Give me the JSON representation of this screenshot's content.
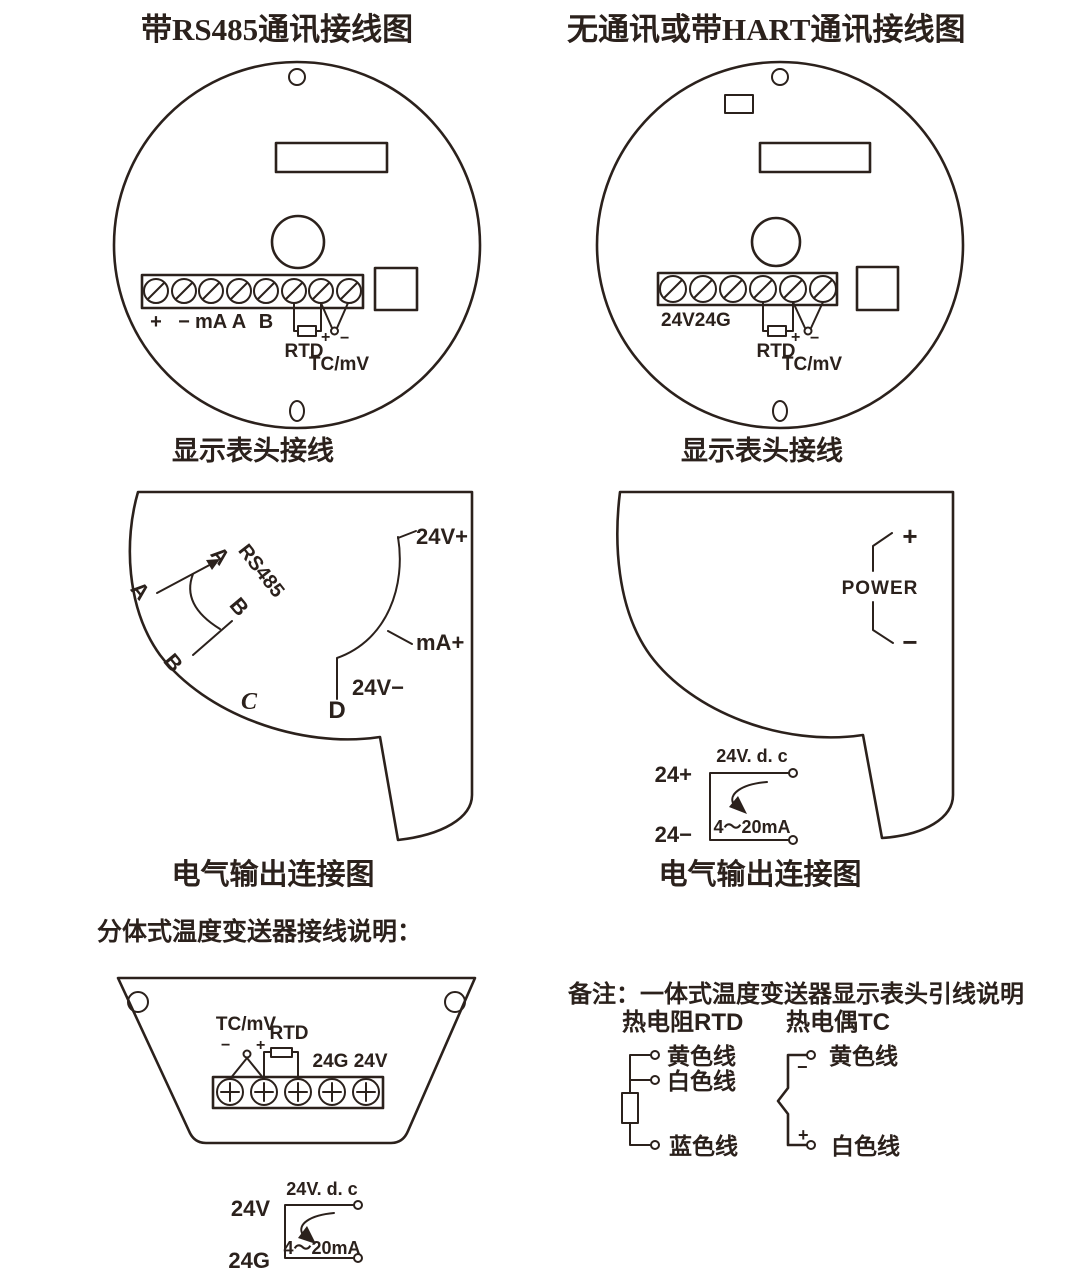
{
  "page": {
    "background": "#ffffff",
    "ink_color": "#2b211c"
  },
  "left_panel": {
    "title": "带RS485通讯接线图",
    "head_caption": "显示表头接线",
    "terminals": [
      "+",
      "−",
      "mA",
      "A",
      "B"
    ],
    "rtd": "RTD",
    "plus": "+",
    "minus": "−",
    "tc": "TC/mV",
    "output_caption": "电气输出连接图",
    "out": {
      "a_upper": "A",
      "a_lower": "A",
      "b_upper": "B",
      "b_lower": "B",
      "c": "C",
      "d": "D",
      "bus": "RS485",
      "v_plus": "24V+",
      "ma_plus": "mA+",
      "v_minus": "24V−"
    }
  },
  "right_panel": {
    "title": "无通讯或带HART通讯接线图",
    "head_caption": "显示表头接线",
    "terminals": "24V24G",
    "rtd": "RTD",
    "plus": "+",
    "minus": "−",
    "tc": "TC/mV",
    "output_caption": "电气输出连接图",
    "out": {
      "plus": "+",
      "minus": "−",
      "power": "POWER"
    },
    "loop": {
      "pos": "24+",
      "neg": "24−",
      "supply": "24V. d. c",
      "current": "4～20mA"
    }
  },
  "split_section": {
    "title": "分体式温度变送器接线说明：",
    "tc": "TC/mV",
    "rtd": "RTD",
    "minus": "−",
    "plus": "+",
    "power": "24G 24V",
    "loop": {
      "pos": "24V",
      "neg": "24G",
      "supply": "24V. d. c",
      "current": "4～20mA"
    }
  },
  "note_section": {
    "title": "备注：一体式温度变送器显示表头引线说明",
    "rtd_title": "热电阻RTD",
    "tc_title": "热电偶TC",
    "rtd_wires": [
      "黄色线",
      "白色线",
      "蓝色线"
    ],
    "tc_minus": "−",
    "tc_plus": "+",
    "tc_wires": [
      "黄色线",
      "白色线"
    ]
  }
}
